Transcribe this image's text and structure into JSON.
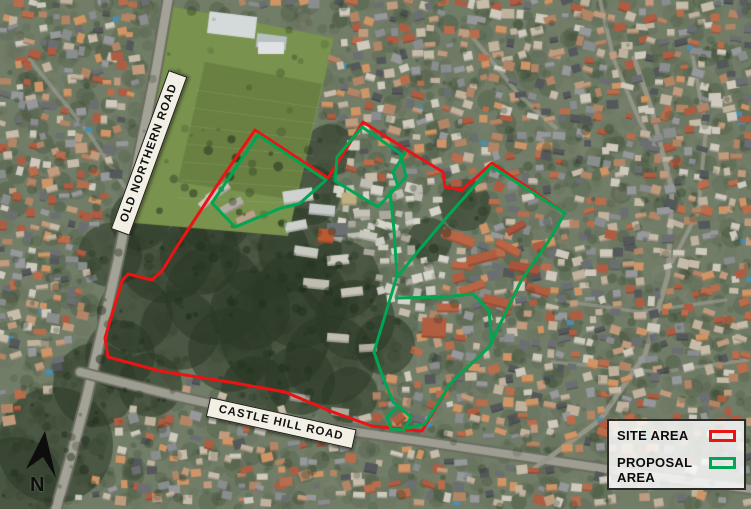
{
  "roads": {
    "old_northern": "OLD NORTHERN ROAD",
    "castle_hill": "CASTLE HILL ROAD"
  },
  "compass": {
    "north_label": "N"
  },
  "overlays": {
    "site_area": {
      "name": "SITE AREA",
      "color": "#ec1313",
      "points": "255,130 222,178 178,245 162,271 152,280 128,274 122,281 105,338 108,357 160,371 235,383 285,392 330,411 372,426 422,431 450,384 489,347 521,281 548,242 565,213 492,163 462,190 445,187 443,172 410,152 363,122 328,178"
    },
    "proposal_area": {
      "name": "PROPOSAL AREA",
      "color": "#00a651",
      "paths": [
        "258,135 326,180 299,204 281,208 235,227 212,203 258,135",
        "401,154 362,127 337,157 335,181 378,207 406,177 401,154",
        "405,153 393,172 398,186 390,192 394,230 397,276 374,352 381,372 393,402 398,406",
        "398,406 411,417 404,430 391,429 387,417 398,406",
        "408,428 425,424 450,384 489,347 521,281 548,242 565,213 494,168",
        "492,166 470,191 447,217 420,249 398,276",
        "397,298 445,297 473,294 489,311 492,343"
      ]
    }
  },
  "legend": {
    "items": [
      {
        "label": "SITE AREA",
        "color": "#ec1313"
      },
      {
        "label": "PROPOSAL AREA",
        "color": "#00a651"
      }
    ]
  }
}
